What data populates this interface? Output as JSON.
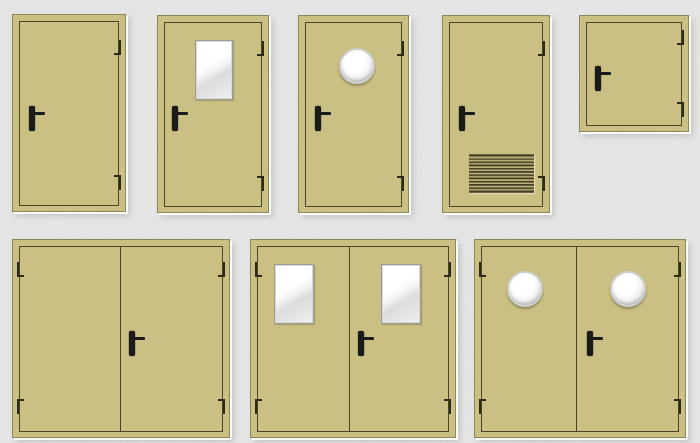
{
  "page": {
    "background_color": "#e9e9e9",
    "texture": "concrete-noise"
  },
  "palette": {
    "door_face": "#cbc084",
    "door_edge_dark": "#8f8659",
    "panel_gap_line": "#4a4429",
    "handle_color": "#1b1b1b",
    "hinge_color": "#2e2a18",
    "window_frame": "#9a9a96",
    "glass_light": "#ffffff",
    "glass_dark": "#dcdcdc",
    "porthole_rim": "#cdcdcd",
    "louver_slat_dark": "#433e25",
    "louver_slat_light": "#c3b87d",
    "emboss_white": "#ffffff"
  },
  "catalog": {
    "items": [
      {
        "id": "single-door-solid",
        "type": "single",
        "x": 12,
        "y": 14,
        "w": 114,
        "h": 198,
        "handle": {
          "x": 16,
          "y": 91
        },
        "hinge_side": "right",
        "hinges_y": [
          25,
          160
        ],
        "features": []
      },
      {
        "id": "single-door-glazed",
        "type": "single",
        "x": 157,
        "y": 15,
        "w": 112,
        "h": 198,
        "handle": {
          "x": 14,
          "y": 90
        },
        "hinge_side": "right",
        "hinges_y": [
          25,
          160
        ],
        "features": [
          {
            "kind": "window",
            "x": 37,
            "y": 24,
            "w": 38,
            "h": 60
          }
        ]
      },
      {
        "id": "single-door-porthole",
        "type": "single",
        "x": 298,
        "y": 15,
        "w": 111,
        "h": 198,
        "handle": {
          "x": 16,
          "y": 90
        },
        "hinge_side": "right",
        "hinges_y": [
          25,
          160
        ],
        "features": [
          {
            "kind": "porthole",
            "cx": 58,
            "cy": 50,
            "r": 18
          }
        ]
      },
      {
        "id": "single-door-louvered",
        "type": "single",
        "x": 442,
        "y": 15,
        "w": 108,
        "h": 198,
        "handle": {
          "x": 16,
          "y": 90
        },
        "hinge_side": "right",
        "hinges_y": [
          25,
          160
        ],
        "features": [
          {
            "kind": "louver",
            "x": 26,
            "y": 138,
            "w": 65,
            "h": 39
          }
        ]
      },
      {
        "id": "technical-hatch",
        "type": "single",
        "x": 579,
        "y": 15,
        "w": 110,
        "h": 117,
        "handle": {
          "x": 15,
          "y": 50
        },
        "hinge_side": "right",
        "hinges_y": [
          14,
          86
        ],
        "features": []
      },
      {
        "id": "double-door-solid",
        "type": "double",
        "x": 12,
        "y": 239,
        "w": 218,
        "h": 199,
        "center_x": 107,
        "handle": {
          "x": 116,
          "y": 91
        },
        "hinge_side": "both",
        "hinges_y": [
          22,
          159
        ],
        "features": []
      },
      {
        "id": "double-door-glazed",
        "type": "double",
        "x": 250,
        "y": 239,
        "w": 206,
        "h": 199,
        "center_x": 98,
        "handle": {
          "x": 107,
          "y": 91
        },
        "hinge_side": "both",
        "hinges_y": [
          22,
          159
        ],
        "features": [
          {
            "kind": "window",
            "x": 23,
            "y": 24,
            "w": 40,
            "h": 60
          },
          {
            "kind": "window",
            "x": 130,
            "y": 24,
            "w": 40,
            "h": 60
          }
        ]
      },
      {
        "id": "double-door-porthole",
        "type": "double",
        "x": 474,
        "y": 239,
        "w": 212,
        "h": 199,
        "center_x": 101,
        "handle": {
          "x": 112,
          "y": 91
        },
        "hinge_side": "both",
        "hinges_y": [
          22,
          159
        ],
        "features": [
          {
            "kind": "porthole",
            "cx": 50,
            "cy": 49,
            "r": 18
          },
          {
            "kind": "porthole",
            "cx": 153,
            "cy": 49,
            "r": 18
          }
        ]
      }
    ]
  }
}
